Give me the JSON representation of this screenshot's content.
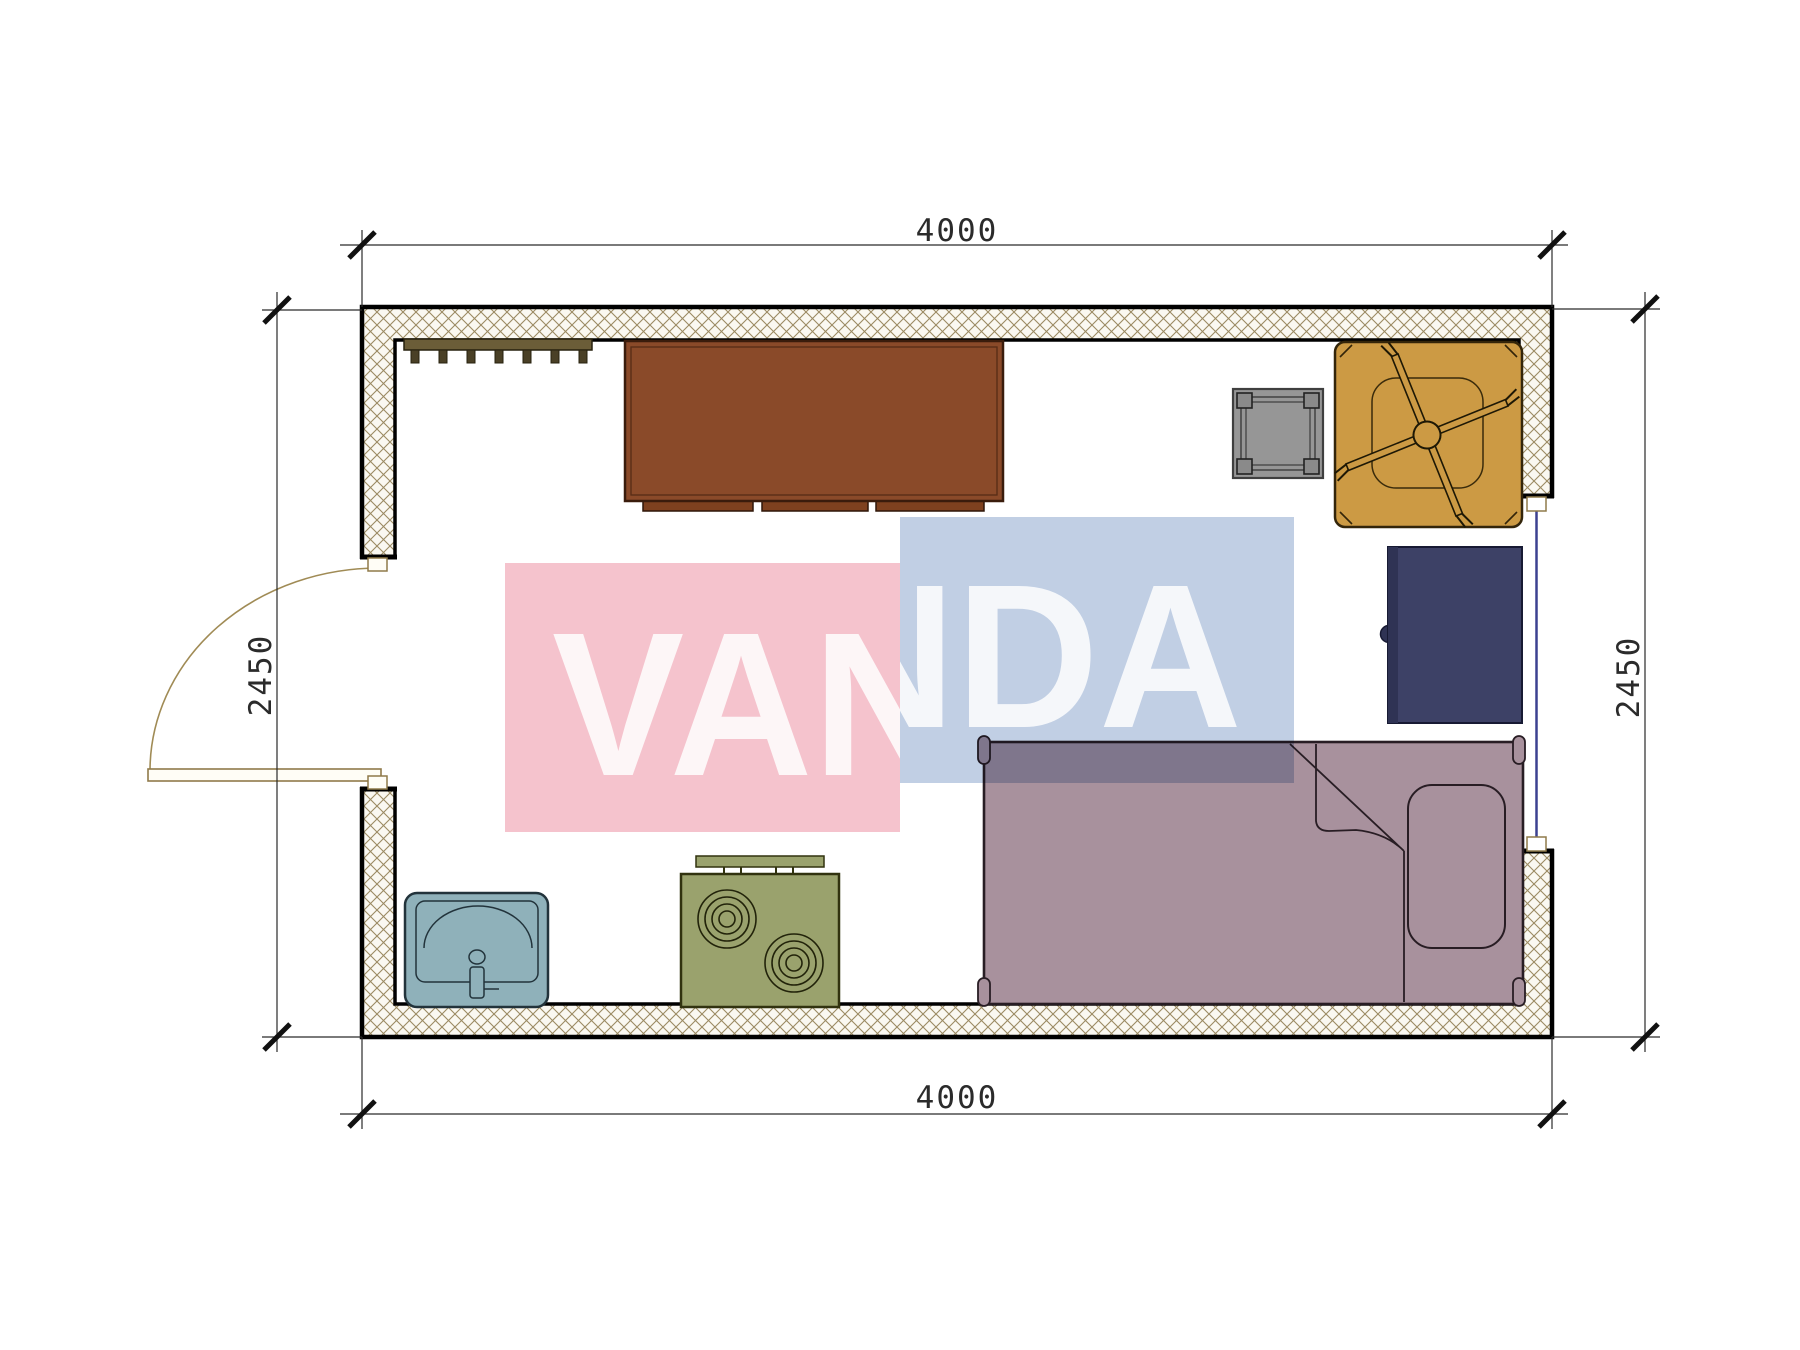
{
  "plan": {
    "type": "floor-plan",
    "dim_top": "4000",
    "dim_bottom": "4000",
    "dim_left": "2450",
    "dim_right": "2450"
  },
  "watermark": {
    "text": "VANDA",
    "pink": "#f5c3cd",
    "blue": "#c1cfe4",
    "text_color": "#ffffff"
  },
  "palette": {
    "wall_fill": "#faf8f1",
    "hatch_line": "#9b8a62",
    "outline": "#000000",
    "dimension_text": "#2b2b2b",
    "door_wood": "#a08b55",
    "window_glass": "#3c4190",
    "coat_rack": "#6b5d38",
    "coat_hook": "#4a4026",
    "desk": "#8a4a29",
    "desk_drawer": "#7e411f",
    "stool": "#969696",
    "stool_leg": "#8a8a8a",
    "fan_table": "#cc9a44",
    "nightstand": "#3d4166",
    "nightstand_edge": "#2f3354",
    "bed": "#a8919d",
    "sink": "#8fb1ba",
    "stove": "#9aa26d"
  }
}
